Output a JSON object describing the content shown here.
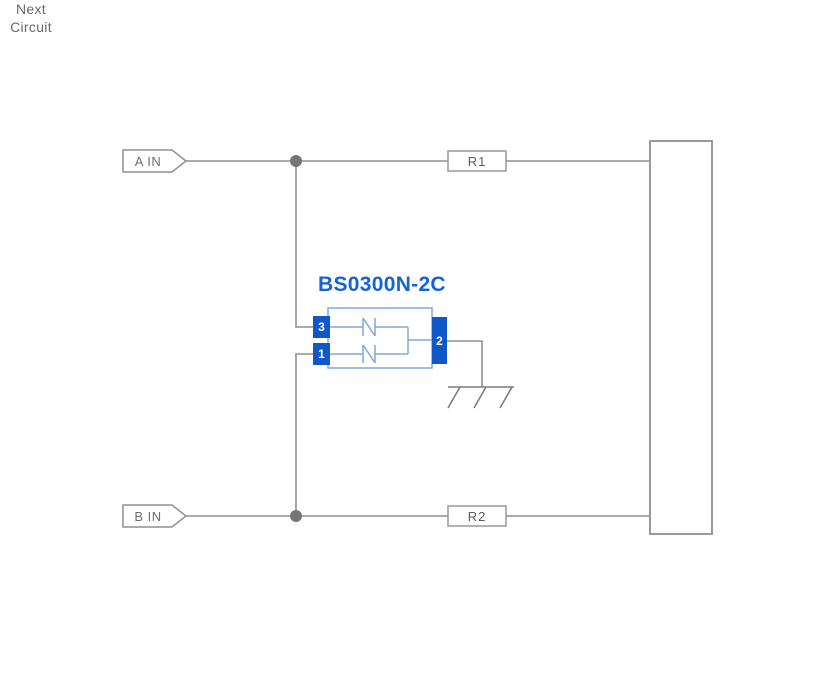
{
  "diagram": {
    "input_tags": [
      {
        "label": "A IN"
      },
      {
        "label": "B IN"
      }
    ],
    "resistors": [
      {
        "label": "R1"
      },
      {
        "label": "R2"
      }
    ],
    "tvs_component": {
      "part_number": "BS0300N-2C",
      "pins": [
        {
          "number": "3"
        },
        {
          "number": "1"
        },
        {
          "number": "2"
        }
      ]
    },
    "next_circuit": {
      "line1": "Next",
      "line2": "Circuit"
    },
    "colors": {
      "accent_blue": "#1464d2",
      "pin_blue": "#1057c8",
      "component_outline_blue": "#7ea9de",
      "wire_gray": "#8f8f8f",
      "junction_gray": "#757575",
      "border_gray": "#999999",
      "text_gray": "#6e6e6e"
    }
  }
}
